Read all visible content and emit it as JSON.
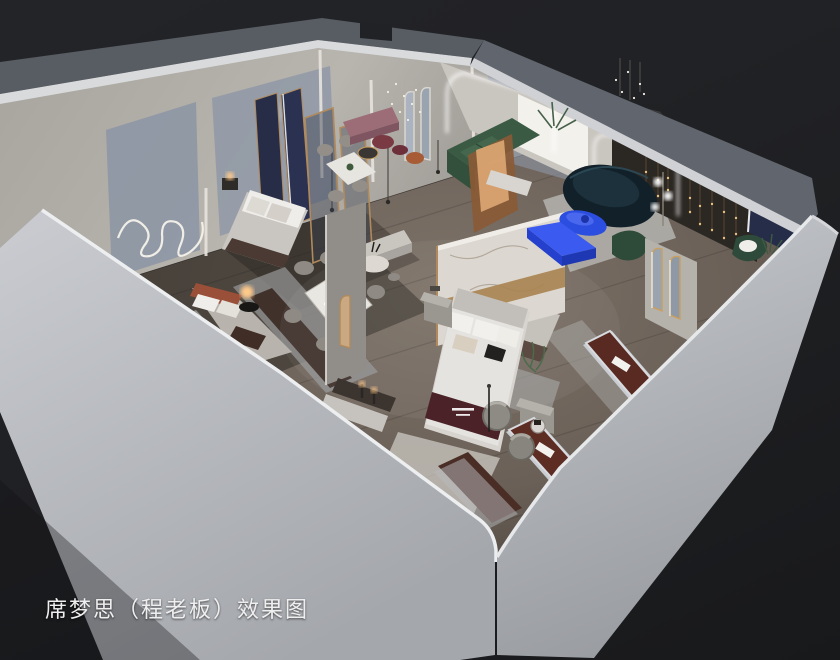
{
  "caption": {
    "text": "席梦思（程老板）效果图"
  },
  "palette": {
    "background": "#232428",
    "background_dark": "#18191b",
    "wall_outer_light": "#c9ccd0",
    "wall_outer_mid": "#a7aaaf",
    "wall_top_dark": "#585c63",
    "wall_edge_highlight": "#eceef0",
    "wall_inner_warm": "#b5b1ab",
    "wall_panel_bluegray": "#8b95a4",
    "floor_wood": "#7d7268",
    "floor_wood_dark": "#4a423c",
    "rug_light": "#b5b4b0",
    "rug_blue_gray": "#8e949c",
    "accent_cobalt": "#2b4de0",
    "accent_teal_dark": "#122029",
    "accent_green": "#3a5a44",
    "accent_navy_panel": "#262d49",
    "accent_mauve": "#9c6d77",
    "accent_burgundy": "#7a3a44",
    "mattress_brown": "#582a21",
    "runner_maroon": "#4a2228",
    "brass_gold": "#b08a5c",
    "bedding_white": "#e5e3df",
    "lamp_warm": "#ffc98a",
    "led_white": "#ffffff",
    "marble_white": "#dcd7d0"
  },
  "scene": {
    "type": "3d-isometric-cutaway-interior-render",
    "objects": [
      "back-wall-northwest",
      "back-wall-northeast",
      "front-wall-southwest",
      "front-wall-southeast",
      "wood-floor",
      "squiggle-wall-art",
      "display-bed-left-room",
      "display-bed-navy-panel-room",
      "display-bed-orange-headboard",
      "center-display-bed",
      "marble-partition-wall",
      "dining-table-six-seats",
      "dining-table-four-seats",
      "round-side-table",
      "green-sectional-sofa",
      "dark-teal-curved-sofa",
      "cobalt-coffee-table",
      "cobalt-console",
      "mauve-bench",
      "burgundy-poufs",
      "wood-display-cabinet",
      "palm-plant",
      "led-arch-opening",
      "arch-mirrors",
      "navy-accent-panel",
      "string-light-chandeliers",
      "brown-display-mattress-1",
      "brown-display-mattress-2",
      "brown-display-mattress-3",
      "fuzzy-swivel-chairs",
      "floor-lamp-globes",
      "bedside-glow-lamp",
      "area-rugs"
    ]
  }
}
